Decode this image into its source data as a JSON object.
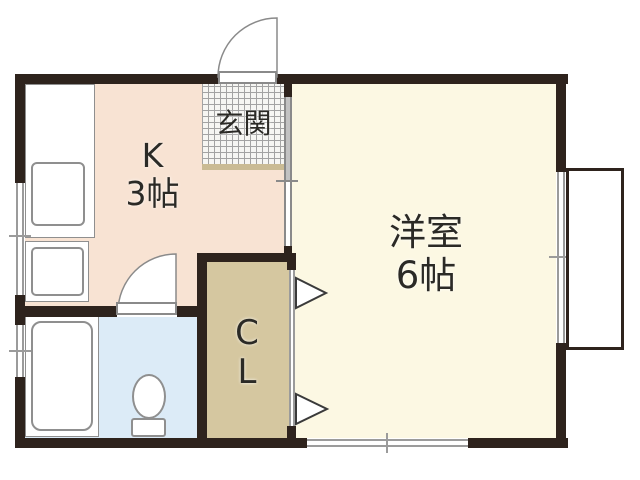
{
  "labels": {
    "entrance": "玄関",
    "kitchen": {
      "line1": "K",
      "line2": "3帖"
    },
    "room": {
      "line1": "洋室",
      "line2": "6帖"
    },
    "closet": {
      "line1": "C",
      "line2": "L"
    }
  },
  "colors": {
    "wall": "#2e231d",
    "kitchen": "#f8e3d3",
    "room": "#fcf8e3",
    "closet": "#d5c7a0",
    "bath": "#dcebf7",
    "genkan_bg": "#f6f6f3",
    "grid": "#a3a3a3",
    "step": "#cabb94",
    "window_line": "#9b9b9b",
    "door_line": "#8a8a8a",
    "door_fill": "#c2c2c2",
    "text": "#2b2a26",
    "canvas": "#ffffff",
    "fixture_line": "#8f8f8f"
  }
}
